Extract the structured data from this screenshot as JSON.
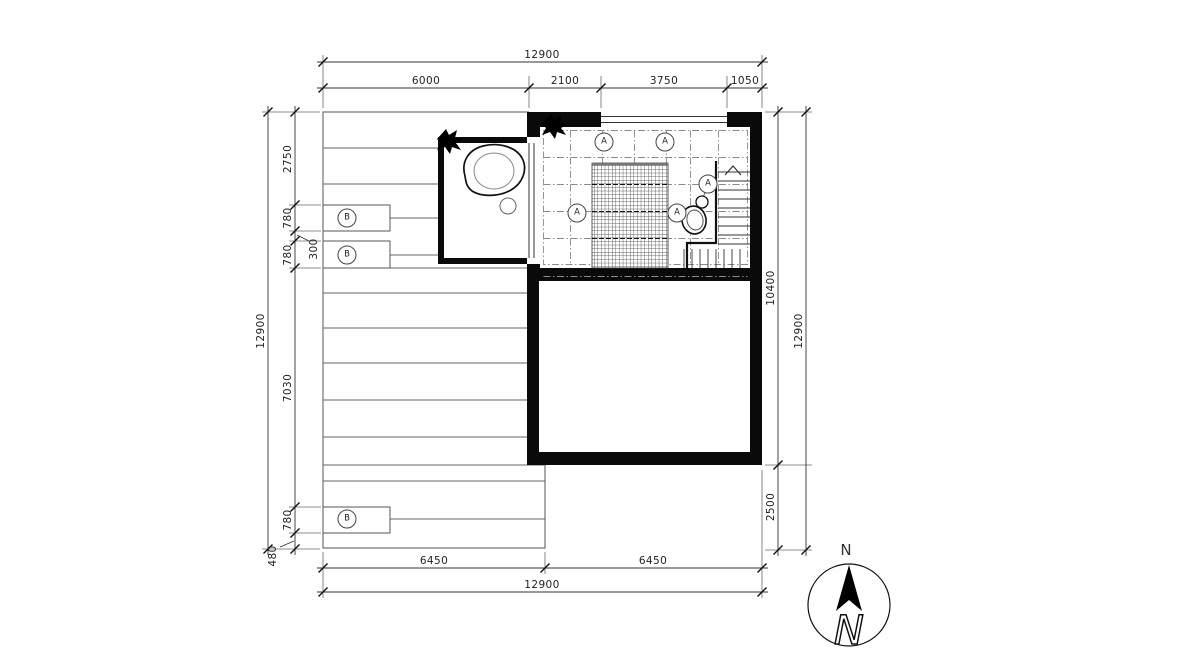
{
  "labels": {
    "ceiling_tag": "A",
    "deck_tag": "B",
    "north": "N"
  },
  "dimensions": {
    "top": {
      "total": "12900",
      "segments": [
        "6000",
        "2100",
        "3750",
        "1050"
      ]
    },
    "left": {
      "total": "12900",
      "segments": [
        "2750",
        "780",
        "300",
        "780",
        "7030",
        "780",
        "480"
      ]
    },
    "right": {
      "total": "12900",
      "segments": [
        "10400",
        "2500"
      ]
    },
    "bottom": {
      "total": "12900",
      "segments": [
        "6450",
        "6450"
      ]
    }
  },
  "colors": {
    "line": "#333333",
    "wall_fill": "#0a0a0a",
    "background": "#ffffff"
  }
}
